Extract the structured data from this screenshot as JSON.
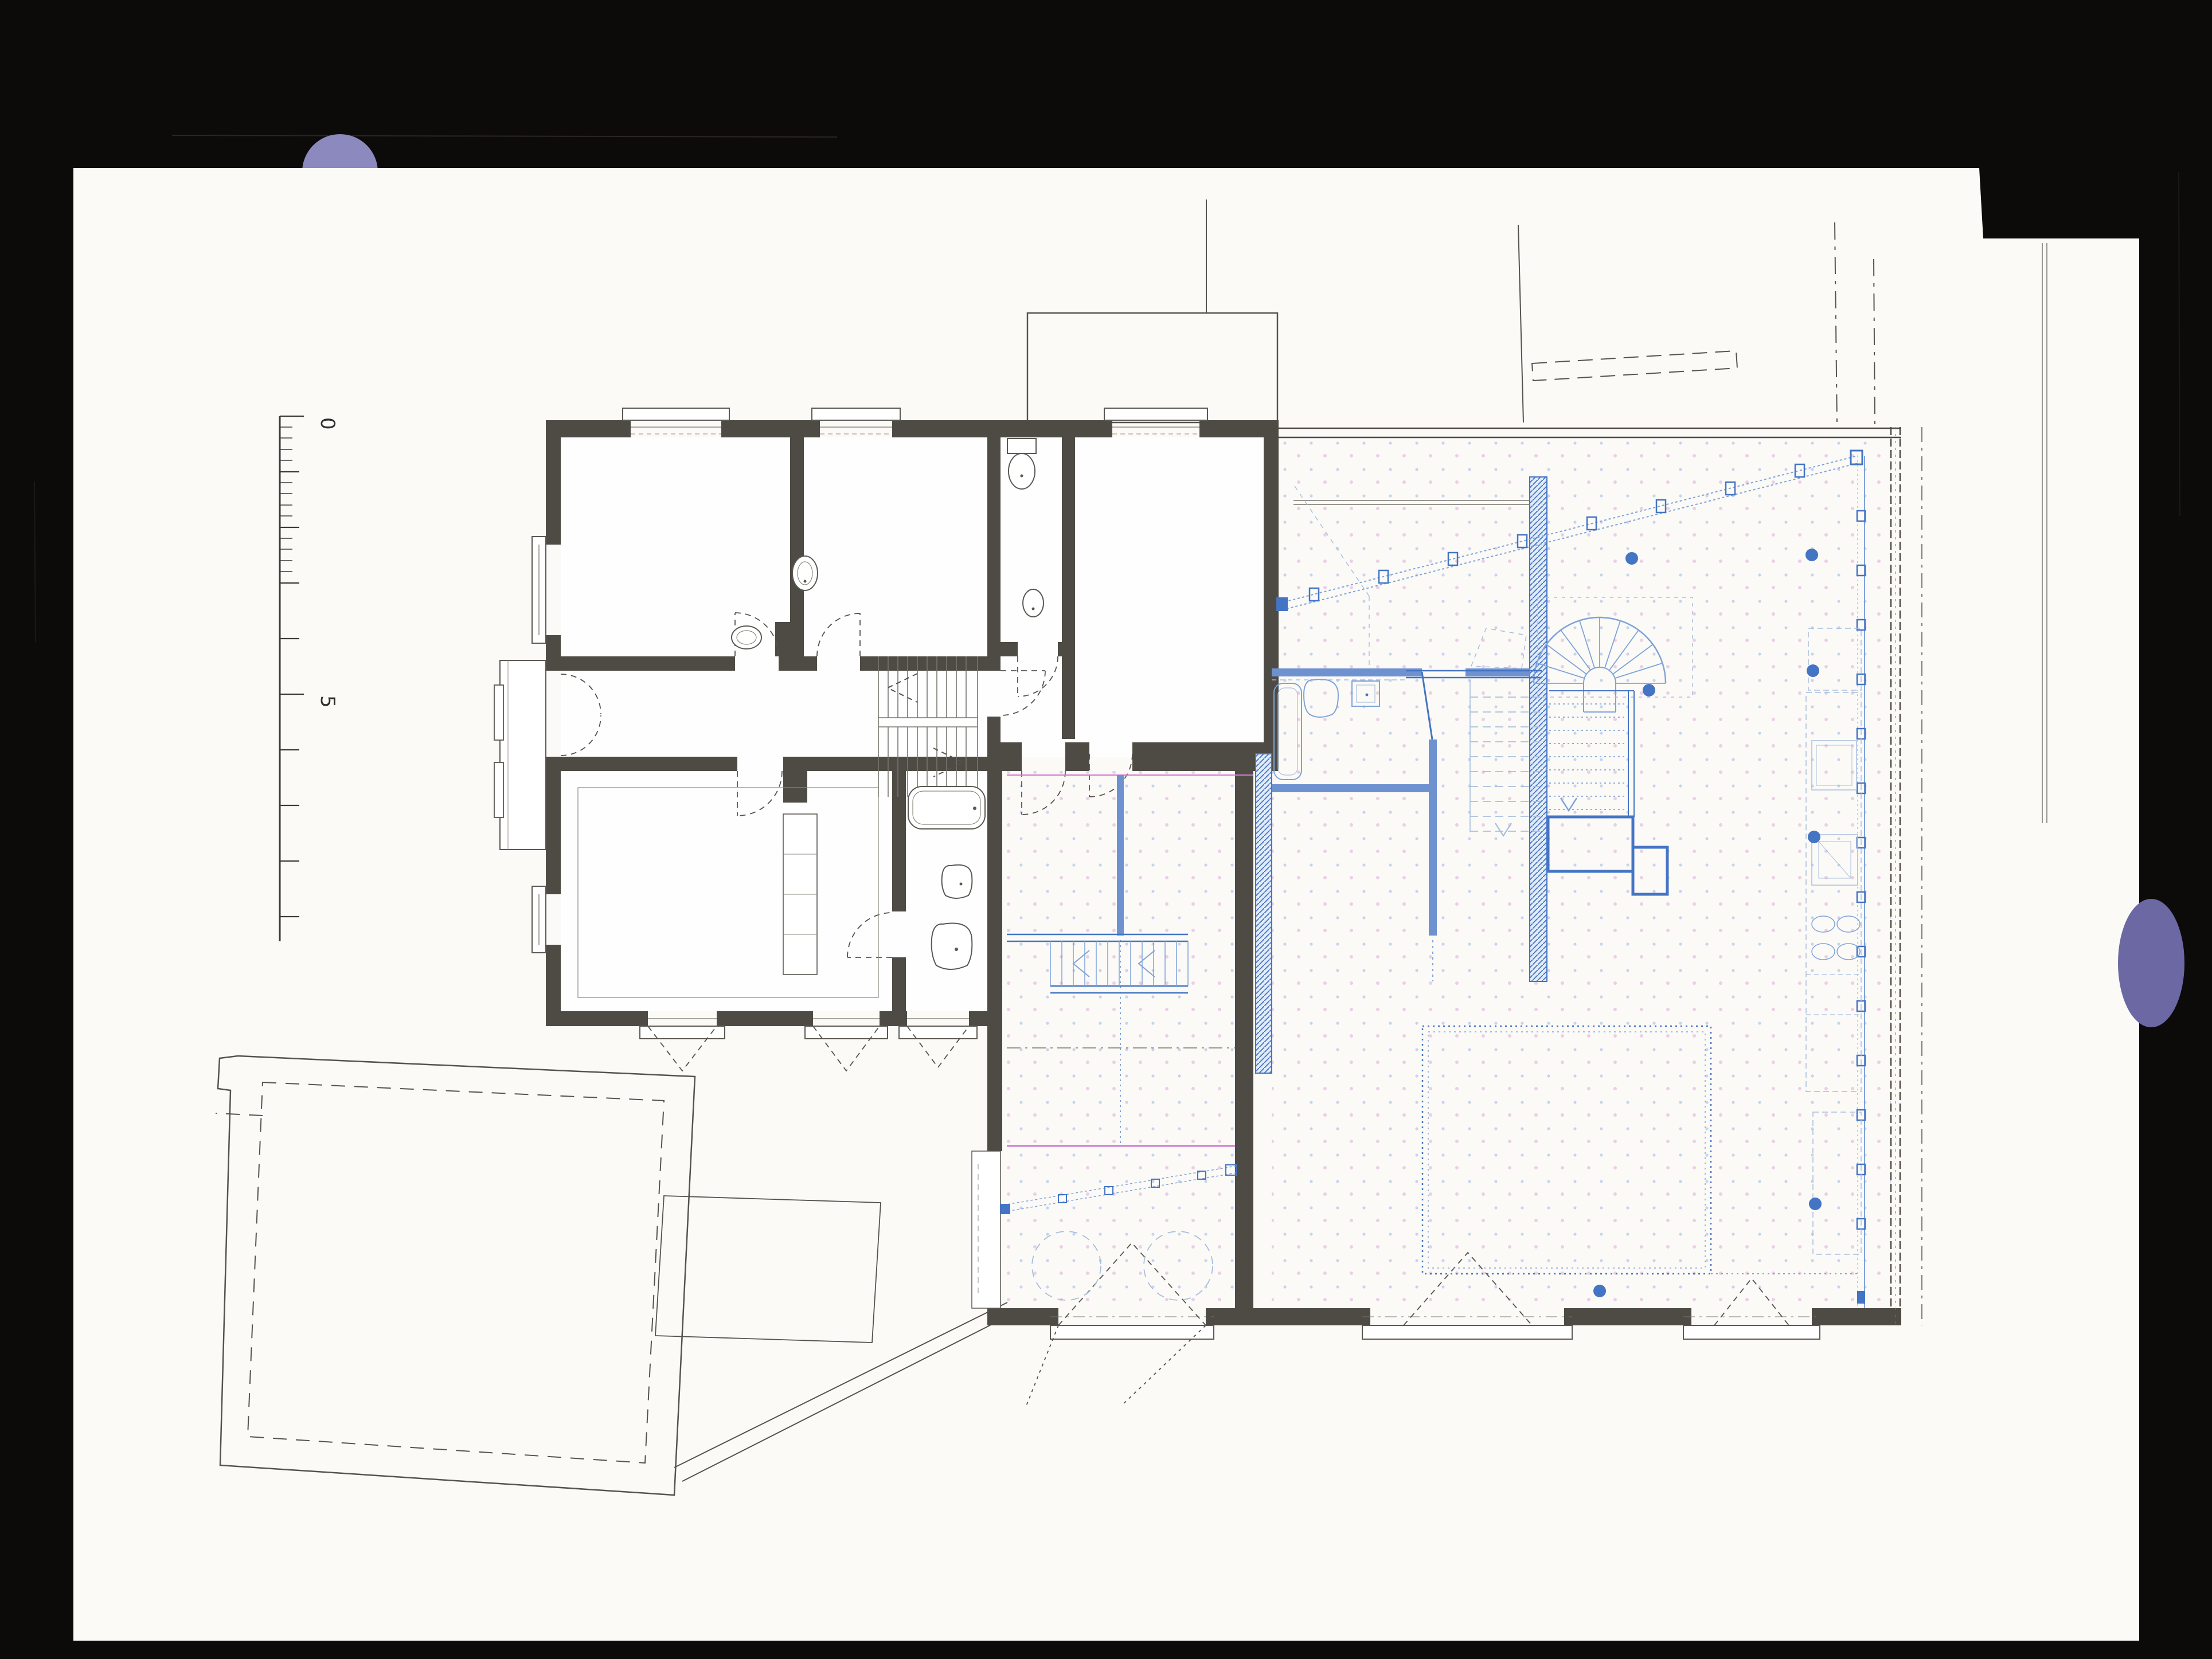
{
  "document": {
    "kind": "scanned architectural floor plan",
    "visible_text": [
      "0",
      "5"
    ]
  },
  "scale_bar": {
    "label_top": "0",
    "label_mid": "5"
  },
  "colors": {
    "scan_background": "#0c0b0a",
    "paper": "#fbfaf7",
    "existing_wall": "#4e4b45",
    "site_line": "#55534e",
    "new_blue": "#4474c4",
    "new_blue_medium": "#7ea3d8",
    "new_blue_mid2": "#6e92cf",
    "new_blue_light": "#a8bedd",
    "floor_dot_pink": "#eacfe6",
    "floor_dot_blue": "#c8d4ec",
    "accent_magenta": "#cf79cf",
    "smudge_top": "#8b89bd",
    "smudge_right": "#6b68a4"
  },
  "legend": {
    "dark_walls": "existing-building",
    "blue_lines": "new-extension",
    "dotted_floor": "new-construction-area",
    "dashed_outline": "site-outbuilding",
    "filled_dots": "structural-columns"
  }
}
